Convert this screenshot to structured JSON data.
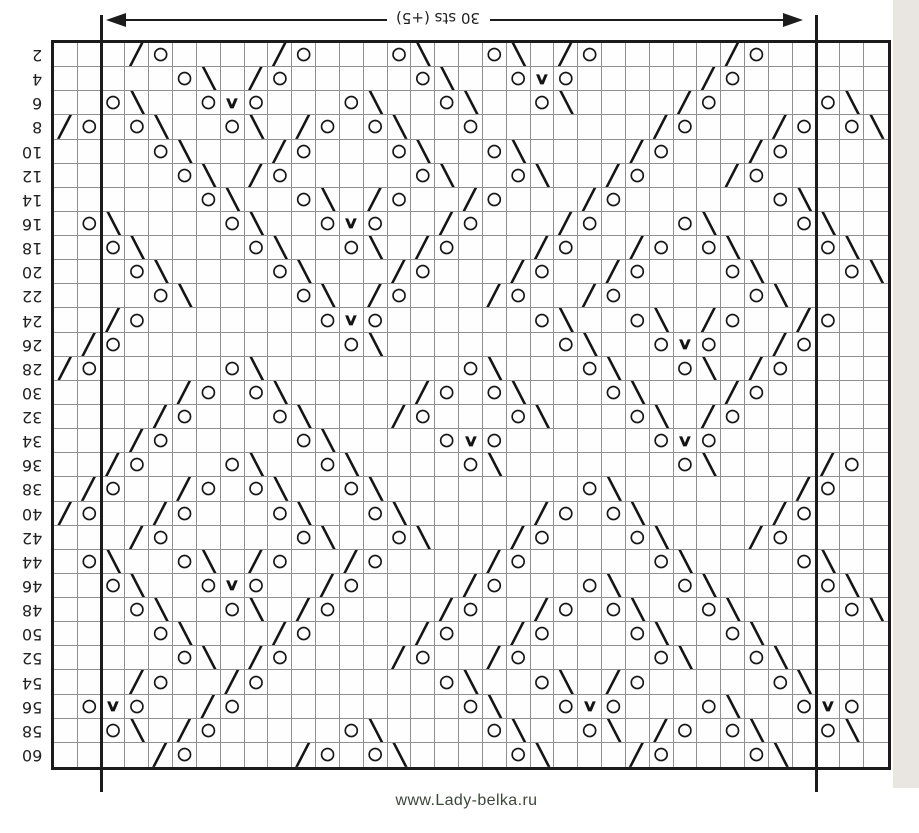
{
  "header": {
    "arrow_label": "30 sts (+5)",
    "repeat_stitches": 30,
    "extra_stitches": 5
  },
  "footer": {
    "website": "www.Lady-belka.ru"
  },
  "colors": {
    "ink": "#1b1b1b",
    "grid_line": "#8f8f8f",
    "footer_text": "#3a463a",
    "scan_edge": "#e9e6e1"
  },
  "glyphs": {
    "O": {
      "char": "○",
      "cls": "sym-o",
      "name": "yarn-over-icon"
    },
    "/": {
      "char": "╱",
      "cls": "sym-d",
      "name": "k2tog-icon"
    },
    "\\": {
      "char": "╲",
      "cls": "sym-d",
      "name": "ssk-icon"
    },
    "V": {
      "char": "∨",
      "cls": "sym-v",
      "name": "double-decrease-icon"
    }
  },
  "grid": {
    "columns": 35,
    "rows": 30,
    "repeat_from_col": 3,
    "repeat_to_col": 32,
    "row_labels": [
      "2",
      "4",
      "6",
      "8",
      "10",
      "12",
      "14",
      "16",
      "18",
      "20",
      "22",
      "24",
      "26",
      "28",
      "30",
      "32",
      "34",
      "36",
      "38",
      "40",
      "42",
      "44",
      "46",
      "48",
      "50",
      "52",
      "54",
      "56",
      "58",
      "60"
    ],
    "cells": [
      ".../O..../O...O\\..O\\./O...../O.....",
      ".....O\\./O.....O\\..OVO...../O......",
      "..O\\..OVO...O\\..O\\..O\\..../O....O\\.",
      "/O.O\\..O\\./O.O\\..O......./O.../O.O\\",
      "....O\\.../O...O\\..O\\..../O.../O....",
      ".....O\\./O.....O\\..O\\../O.../O.....",
      "......O\\..O\\./O../O.../O......O\\...",
      ".O\\....O\\..OVO../O.../O...O\\...O\\..",
      "..O\\....O\\..O\\./O.../O../O.O\\...O\\.",
      "...O\\....O\\.../O.../O../O...O\\...O\\",
      "....O\\....O\\./O.../O../O.....O\\....",
      "../O.......OVO......O\\..O\\./O../O..",
      "./O.........O\\.......O\\..OVO../O...",
      "/O.....O\\........O\\...O\\..O\\./O....",
      "...../O.O\\...../O.O\\...O\\.../O.....",
      "..../O...O\\.../O...O\\...O\\./O......",
      ".../O.....O\\....OVO......OVO.......",
      "../O...O\\..O\\....O\\.......O\\..../O.",
      "./O../O.O\\..O\\........O\\......./O..",
      "/O../O...O\\..O\\...../O.O\\...../O...",
      ".../O.....O\\..O\\.../O...O\\.../O....",
      ".O\\..O\\./O../O..../O.....O\\....O\\..",
      "..O\\..OVO../O..../O...O\\..O\\....O\\.",
      "...O\\..O\\./O..../O../O.O\\..O\\....O\\",
      "....O\\.../O..../O../O...O\\..O\\.....",
      ".....O\\./O..../O../O.....O\\..O\\....",
      ".../O../O.......O\\..O\\./O.....O\\...",
      ".OVO../O.........O\\..OVO...O\\..OVO.",
      "..O\\./O.....O\\....O\\..O\\./O.O\\..O\\.",
      "..../O..../O.O\\....O\\.../O...O\\...."
    ]
  }
}
